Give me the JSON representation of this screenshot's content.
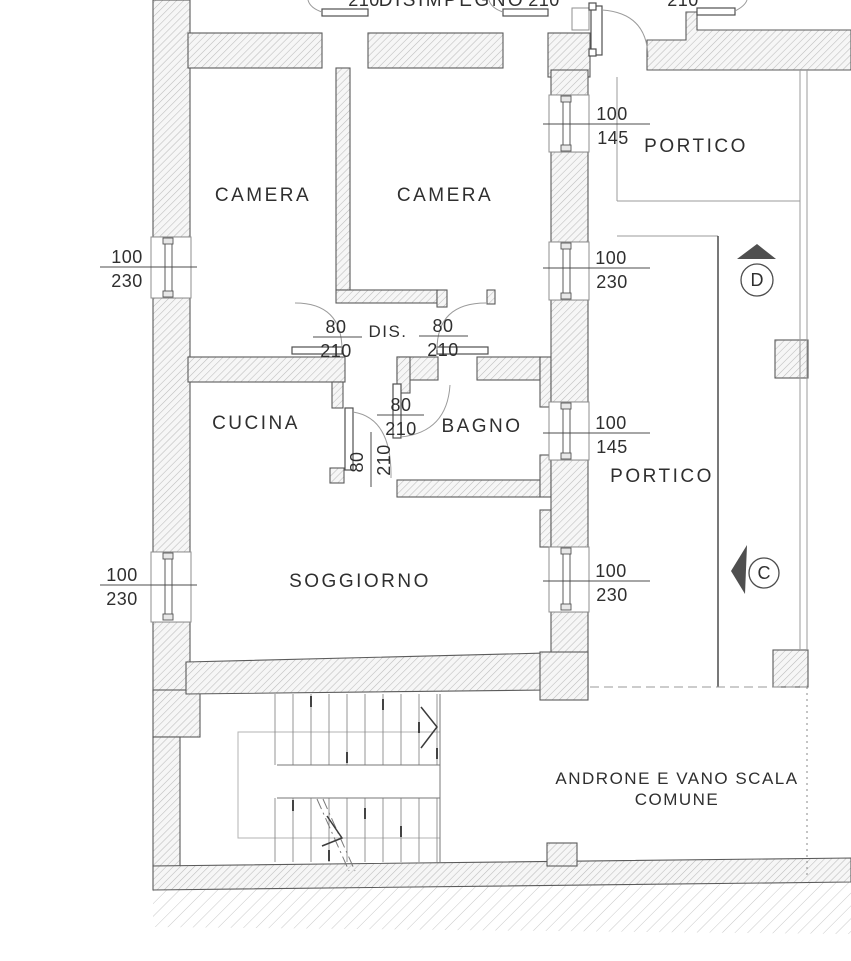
{
  "plan": {
    "labels": {
      "disimpegno": "DISIMPEGNO",
      "camera_left": "CAMERA",
      "camera_right": "CAMERA",
      "dis": "DIS.",
      "cucina": "CUCINA",
      "bagno": "BAGNO",
      "soggiorno": "SOGGIORNO",
      "portico_upper": "PORTICO",
      "portico_lower": "PORTICO",
      "androne_line1": "ANDRONE E VANO SCALA",
      "androne_line2": "COMUNE"
    },
    "top_dims": {
      "left": "210",
      "mid": "210",
      "right": "210"
    },
    "door_dims": {
      "dis_left": {
        "num": "80",
        "den": "210"
      },
      "dis_right": {
        "num": "80",
        "den": "210"
      },
      "bagno": {
        "num": "80",
        "den": "210"
      },
      "cucina": {
        "num": "80",
        "den": "210"
      }
    },
    "window_dims": {
      "left_upper": {
        "num": "100",
        "den": "230"
      },
      "left_lower": {
        "num": "100",
        "den": "230"
      },
      "right_top": {
        "num": "100",
        "den": "145"
      },
      "right_upper_mid": {
        "num": "100",
        "den": "230"
      },
      "right_lower_mid": {
        "num": "100",
        "den": "145"
      },
      "right_bottom": {
        "num": "100",
        "den": "230"
      }
    },
    "section_markers": {
      "d": "D",
      "c": "C"
    },
    "colors": {
      "wall_hatch": "#bcbcbc",
      "wall_fill": "#f6f6f6",
      "ground_hatch": "#c9c9c9",
      "line_dark": "#4c4c4c",
      "line_mid": "#9a9a9a",
      "text": "#2f2f2f",
      "marker_fill": "#4f4f4f"
    }
  }
}
